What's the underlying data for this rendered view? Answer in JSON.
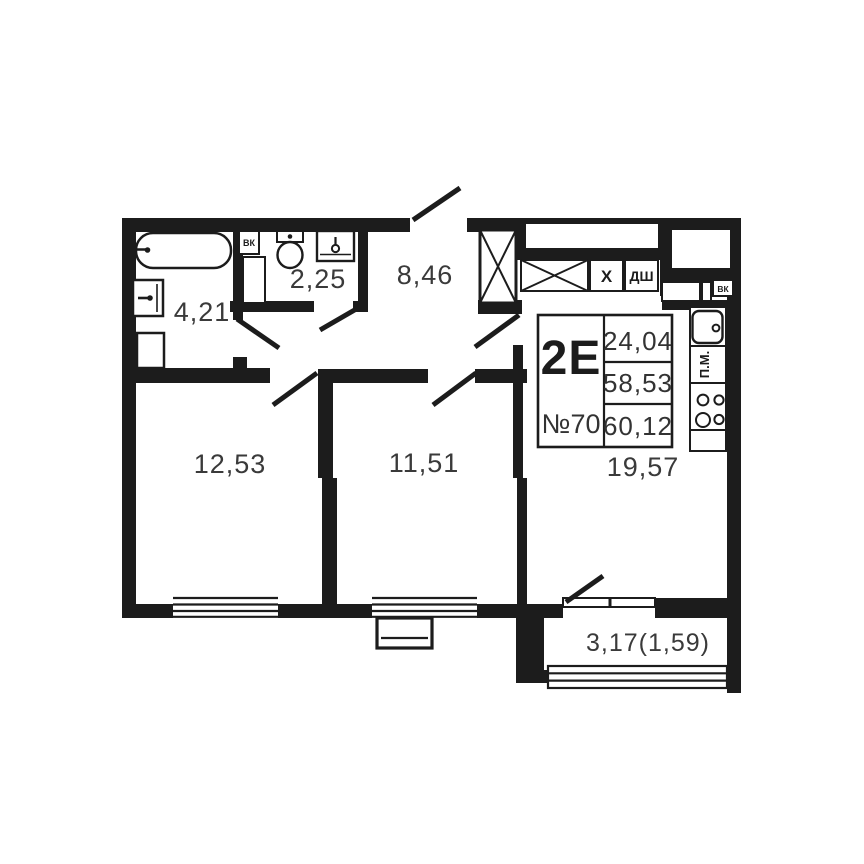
{
  "unit_card": {
    "type_label": "2Е",
    "number": "№70",
    "living_area": "24,04",
    "area_without_balcony": "58,53",
    "total_area": "60,12"
  },
  "rooms": {
    "bathroom": "4,21",
    "toilet": "2,25",
    "hallway": "8,46",
    "bedroom_1": "12,53",
    "bedroom_2": "11,51",
    "kitchen_living": "19,57",
    "balcony": "3,17(1,59)"
  },
  "labels": {
    "duct_bathroom": "ВК",
    "duct_kitchen": "ВК",
    "drain_shaft": "ДШ",
    "vent_box": "Х",
    "dishwasher": "П.М."
  },
  "colors": {
    "walls": "#1c1c1c",
    "text": "#3a3a3a",
    "background": "#ffffff"
  }
}
